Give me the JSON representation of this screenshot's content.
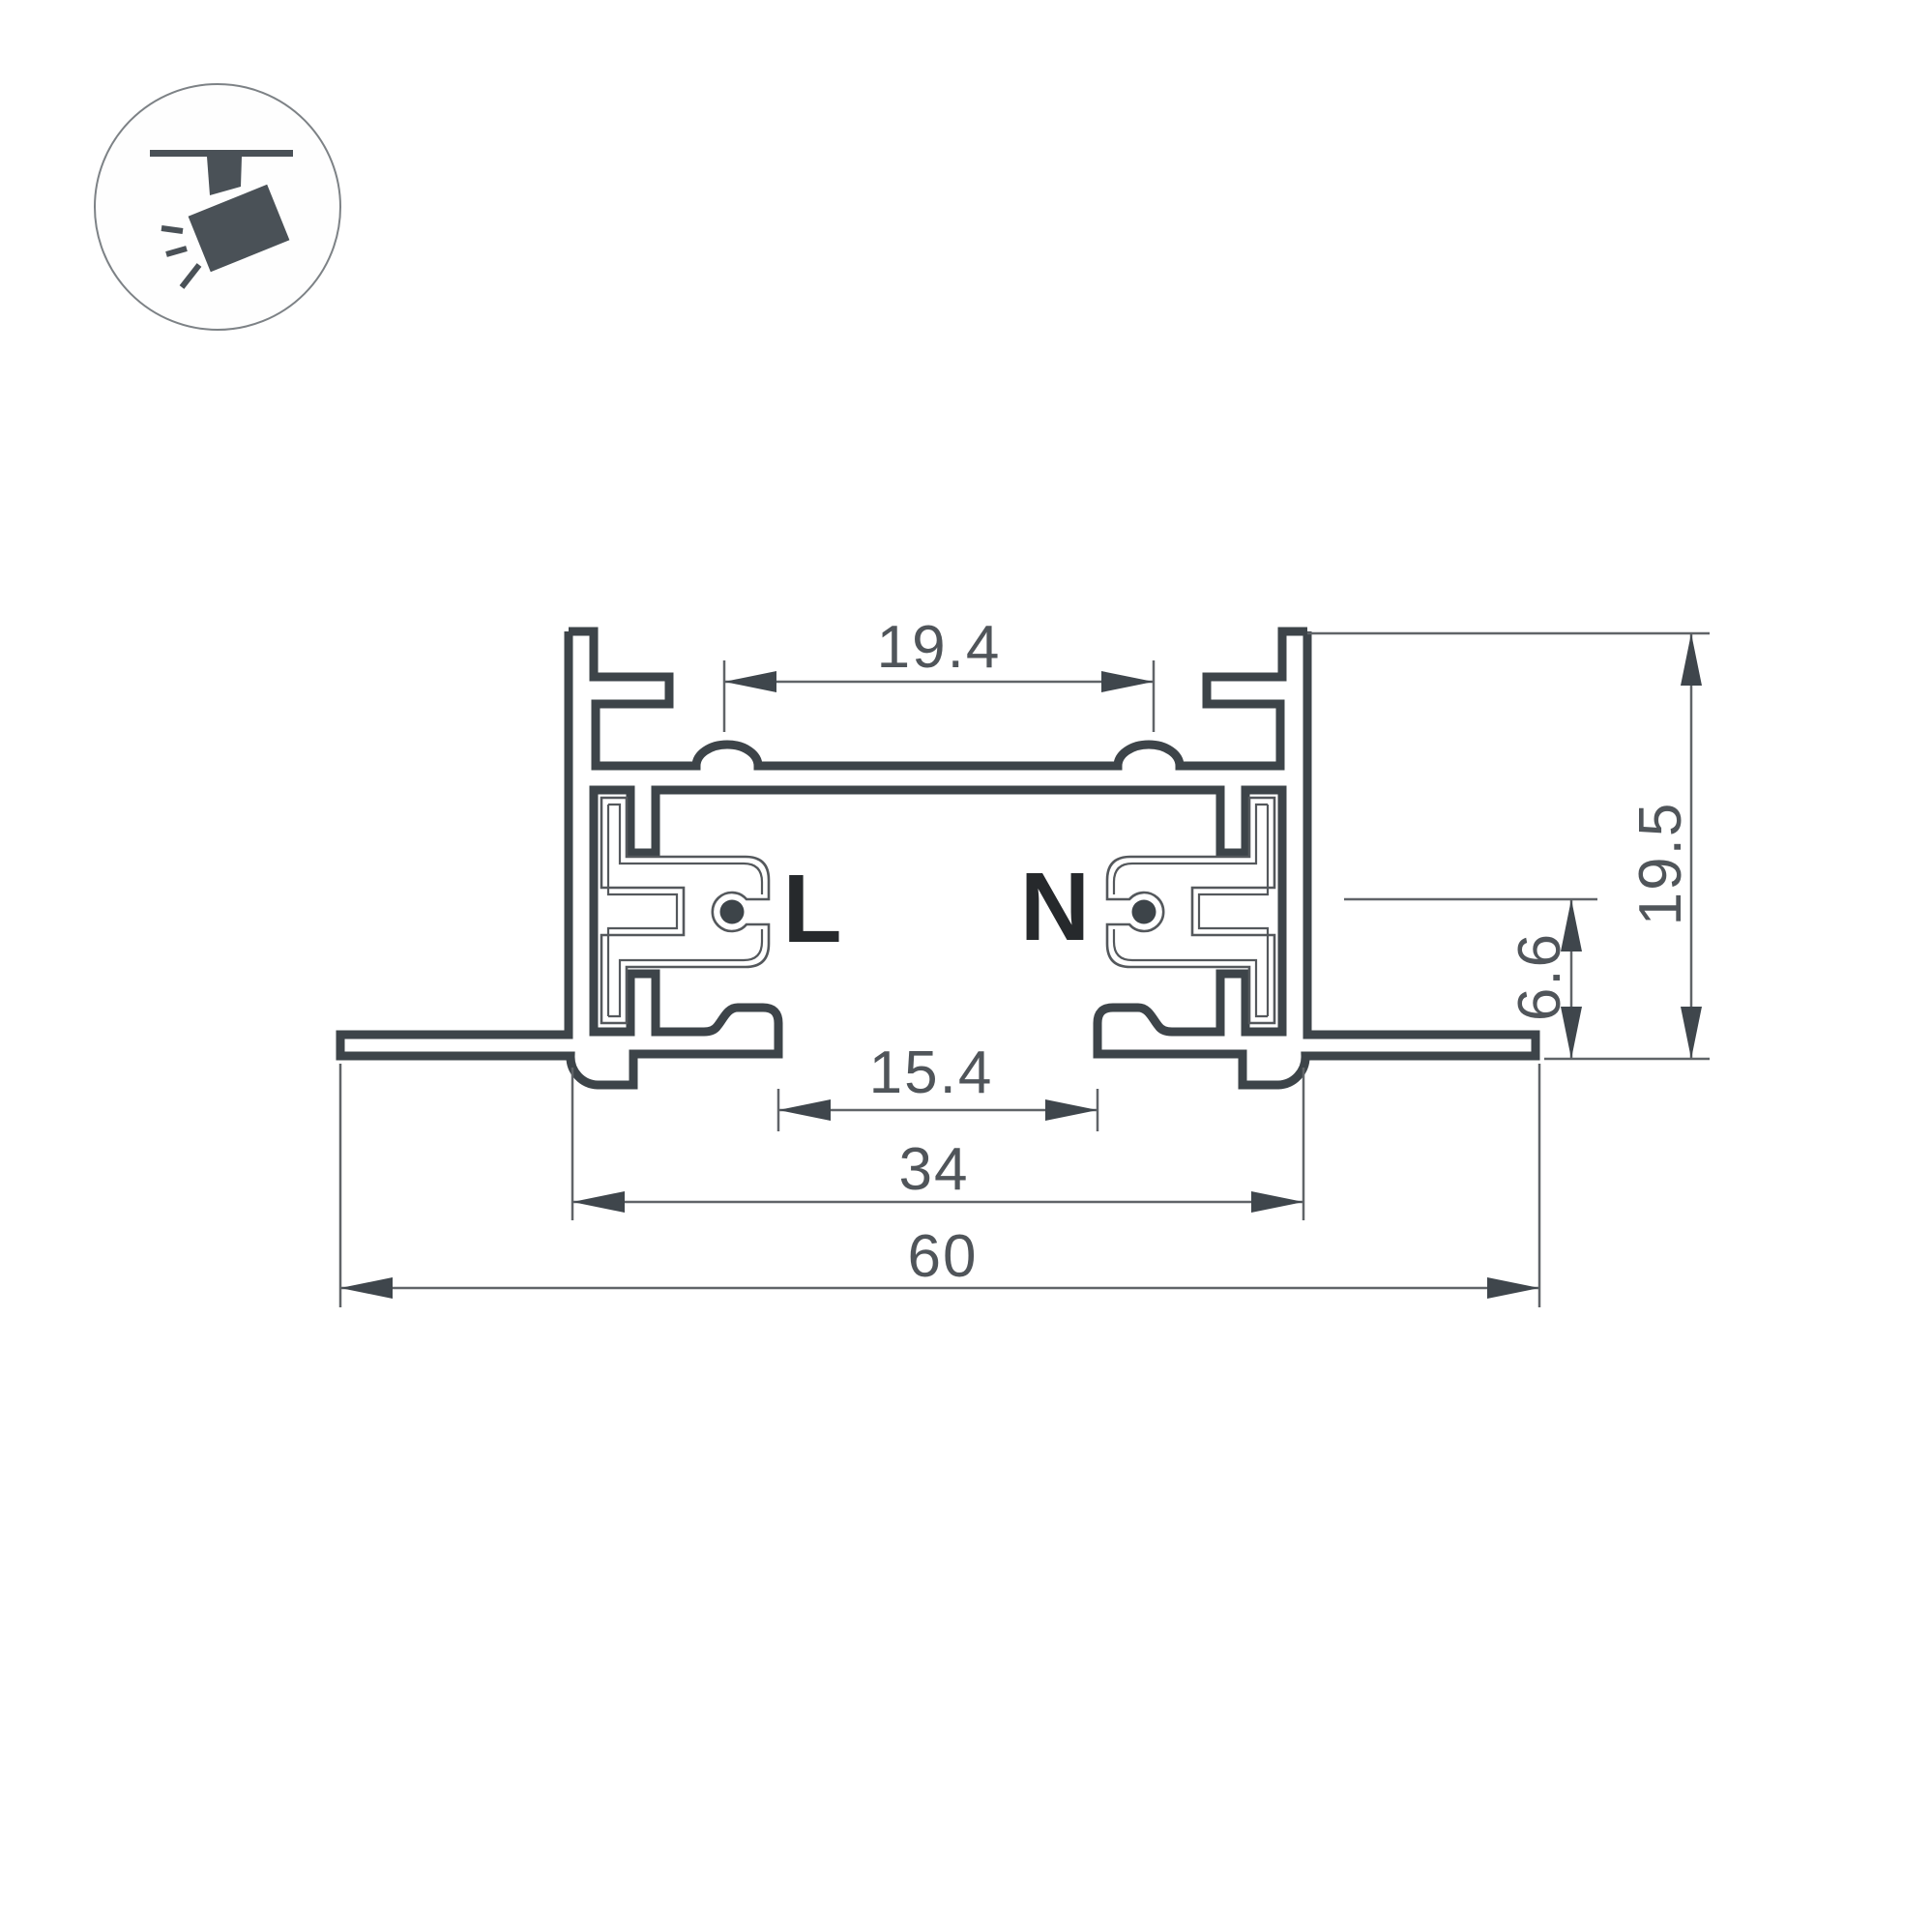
{
  "icon": {
    "name": "track-spotlight-icon",
    "fill_color": "#4a5157",
    "circle_stroke": "#7d8286"
  },
  "labels": {
    "live": "L",
    "neutral": "N"
  },
  "dimensions": {
    "top_inner_width": "19.4",
    "overall_height": "19.5",
    "recess_depth": "6.6",
    "bottom_opening_width": "15.4",
    "body_width": "34",
    "overall_width": "60"
  },
  "colors": {
    "profile_line": "#3d4449",
    "insulator_line": "#54585c",
    "dimension_line": "#606468",
    "arrow_fill": "#3f464c",
    "dimension_text": "#50555a",
    "conductor_label_text": "#26292c",
    "background": "#ffffff"
  }
}
